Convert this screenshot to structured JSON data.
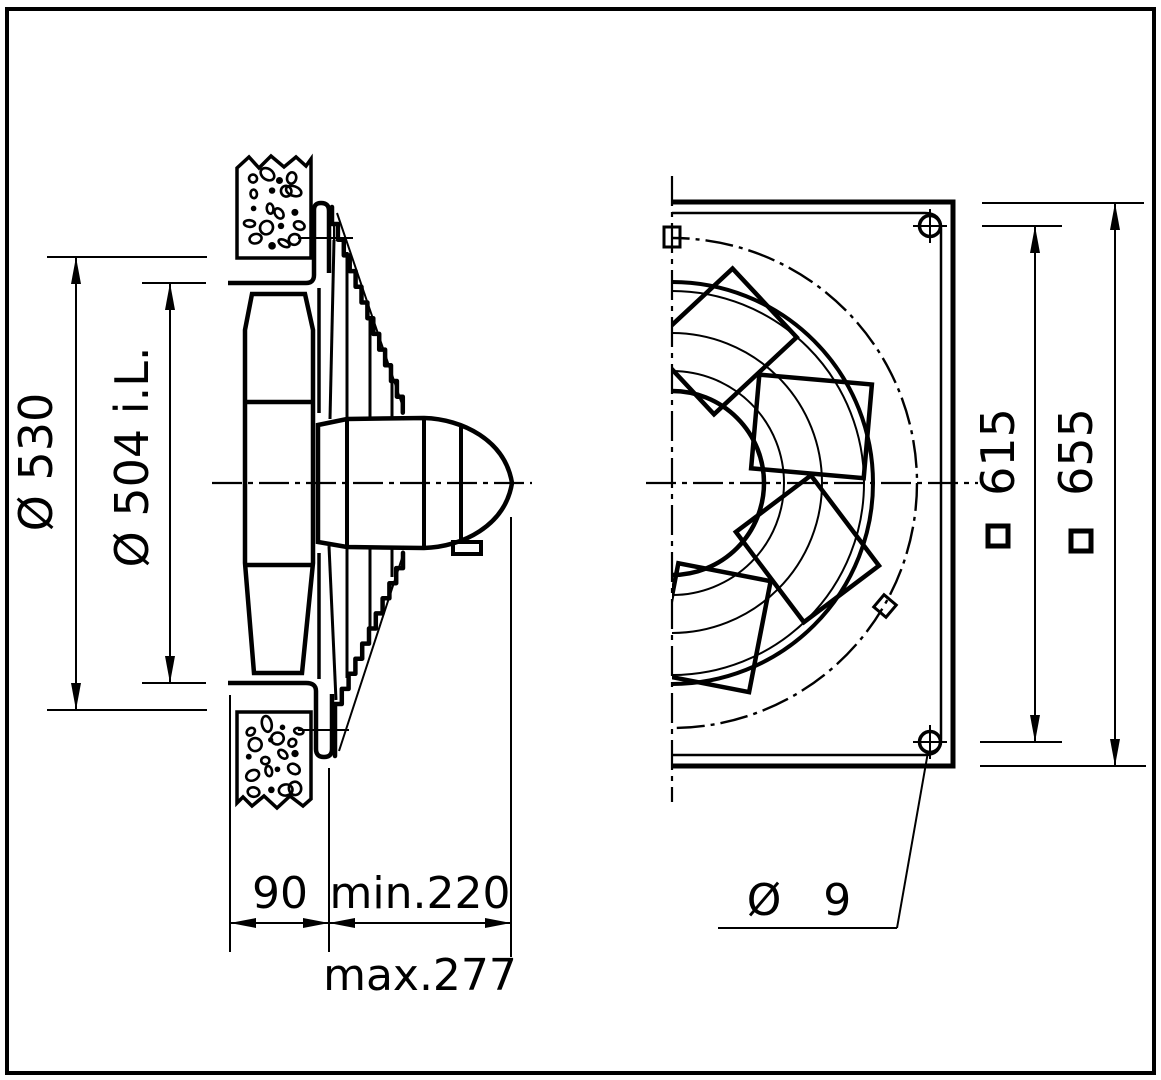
{
  "page": {
    "background": "#ffffff",
    "ink": "#000000"
  },
  "drawing": {
    "kind": "technical dimension drawing",
    "subject": "wall-mounted axial fan, side section and front view",
    "side_view": {
      "wall_opening_diameter": "Ø 530",
      "duct_inner_diameter": "Ø 504 i.L.",
      "wall_duct_length": "90",
      "min_depth": "min.220",
      "max_depth": "max.277"
    },
    "front_view": {
      "mounting_hole_pitch": "615",
      "wall_plate_size": "655",
      "mounting_hole_diameter": "Ø 9",
      "square_symbol": "square"
    }
  }
}
